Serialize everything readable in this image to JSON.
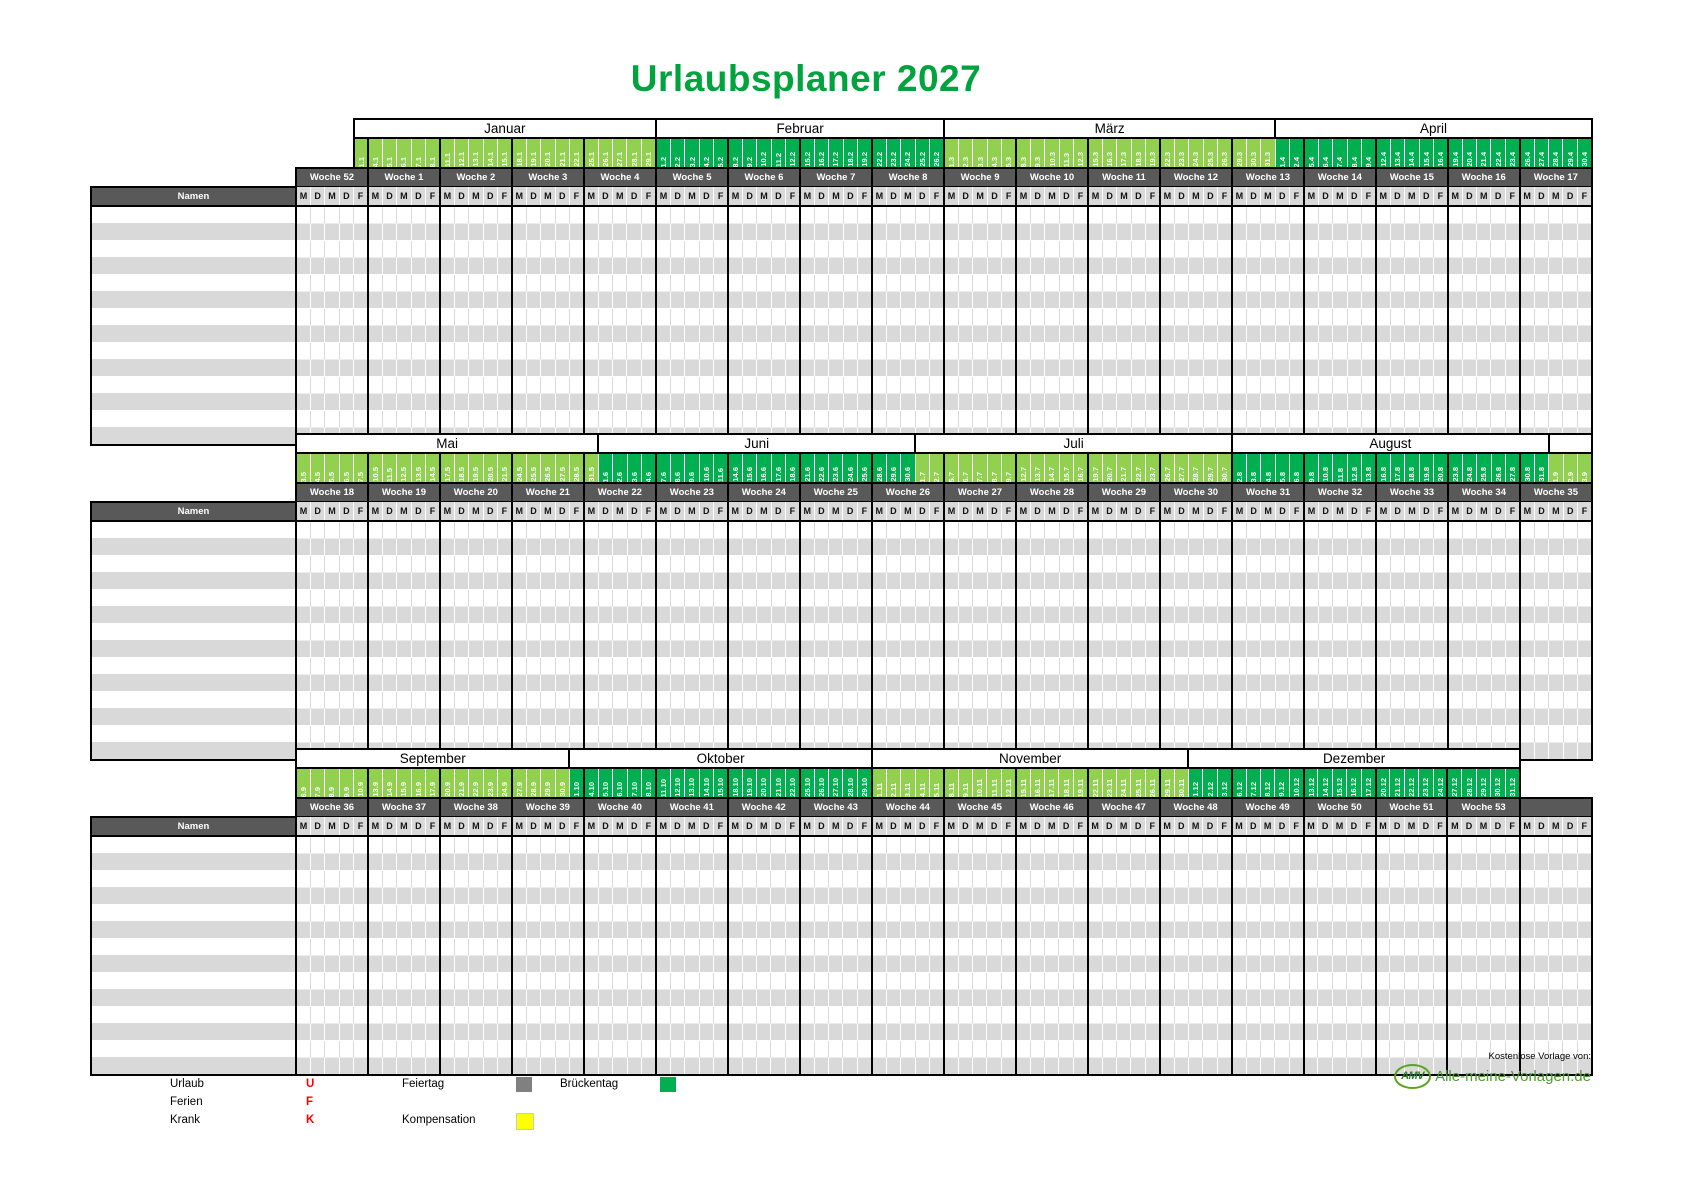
{
  "title": "Urlaubsplaner 2027",
  "names_label": "Namen",
  "day_letters": [
    "M",
    "D",
    "M",
    "D",
    "F"
  ],
  "body_rows": 14,
  "colors": {
    "light_green": "#92d050",
    "dark_green": "#00b050",
    "header_gray": "#595959",
    "row_gray": "#d9d9d9",
    "title_green": "#00a33e",
    "legend_red": "#ff0000",
    "feiertag_gray": "#808080",
    "kompensation_yellow": "#ffff00",
    "brueckentag_green": "#00b050",
    "logo_green": "#58a618"
  },
  "layout": {
    "name_col_width": 205,
    "day_col_width": 14.4,
    "band_tops": [
      118,
      433,
      748
    ]
  },
  "bands": [
    {
      "months": [
        {
          "label": "",
          "span": 4,
          "boxed": false
        },
        {
          "label": "Januar",
          "span": 21,
          "boxed": true
        },
        {
          "label": "Februar",
          "span": 20,
          "boxed": true
        },
        {
          "label": "März",
          "span": 23,
          "boxed": true
        },
        {
          "label": "April",
          "span": 22,
          "boxed": true
        }
      ],
      "weeks": [
        {
          "label": "Woche 52",
          "dates": [
            "",
            "",
            "",
            "",
            "1.1"
          ],
          "shade": "L"
        },
        {
          "label": "Woche 1",
          "dates": [
            "4.1",
            "5.1",
            "6.1",
            "7.1",
            "8.1"
          ],
          "shade": "L"
        },
        {
          "label": "Woche 2",
          "dates": [
            "11.1",
            "12.1",
            "13.1",
            "14.1",
            "15.1"
          ],
          "shade": "L"
        },
        {
          "label": "Woche 3",
          "dates": [
            "18.1",
            "19.1",
            "20.1",
            "21.1",
            "22.1"
          ],
          "shade": "L"
        },
        {
          "label": "Woche 4",
          "dates": [
            "25.1",
            "26.1",
            "27.1",
            "28.1",
            "29.1"
          ],
          "shade": "L"
        },
        {
          "label": "Woche 5",
          "dates": [
            "1.2",
            "2.2",
            "3.2",
            "4.2",
            "5.2"
          ],
          "shade": "D"
        },
        {
          "label": "Woche 6",
          "dates": [
            "8.2",
            "9.2",
            "10.2",
            "11.2",
            "12.2"
          ],
          "shade": "D"
        },
        {
          "label": "Woche 7",
          "dates": [
            "15.2",
            "16.2",
            "17.2",
            "18.2",
            "19.2"
          ],
          "shade": "D"
        },
        {
          "label": "Woche 8",
          "dates": [
            "22.2",
            "23.2",
            "24.2",
            "25.2",
            "26.2"
          ],
          "shade": "D"
        },
        {
          "label": "Woche 9",
          "dates": [
            "1.3",
            "2.3",
            "3.3",
            "4.3",
            "5.3"
          ],
          "shade": "L"
        },
        {
          "label": "Woche 10",
          "dates": [
            "8.3",
            "9.3",
            "10.3",
            "11.3",
            "12.3"
          ],
          "shade": "L"
        },
        {
          "label": "Woche 11",
          "dates": [
            "15.3",
            "16.3",
            "17.3",
            "18.3",
            "19.3"
          ],
          "shade": "L"
        },
        {
          "label": "Woche 12",
          "dates": [
            "22.3",
            "23.3",
            "24.3",
            "25.3",
            "26.3"
          ],
          "shade": "L"
        },
        {
          "label": "Woche 13",
          "dates": [
            "29.3",
            "30.3",
            "31.3",
            "1.4",
            "2.4"
          ],
          "shades": [
            "L",
            "L",
            "L",
            "D",
            "D"
          ]
        },
        {
          "label": "Woche 14",
          "dates": [
            "5.4",
            "6.4",
            "7.4",
            "8.4",
            "9.4"
          ],
          "shade": "D"
        },
        {
          "label": "Woche 15",
          "dates": [
            "12.4",
            "13.4",
            "14.4",
            "15.4",
            "16.4"
          ],
          "shade": "D"
        },
        {
          "label": "Woche 16",
          "dates": [
            "19.4",
            "20.4",
            "21.4",
            "22.4",
            "23.4"
          ],
          "shade": "D"
        },
        {
          "label": "Woche 17",
          "dates": [
            "26.4",
            "27.4",
            "28.4",
            "29.4",
            "30.4"
          ],
          "shade": "D"
        }
      ]
    },
    {
      "months": [
        {
          "label": "Mai",
          "span": 21,
          "boxed": true
        },
        {
          "label": "Juni",
          "span": 22,
          "boxed": true
        },
        {
          "label": "Juli",
          "span": 22,
          "boxed": true
        },
        {
          "label": "August",
          "span": 22,
          "boxed": true
        },
        {
          "label": "",
          "span": 3,
          "boxed": true
        }
      ],
      "weeks": [
        {
          "label": "Woche 18",
          "dates": [
            "3.5",
            "4.5",
            "5.5",
            "6.5",
            "7.5"
          ],
          "shade": "L"
        },
        {
          "label": "Woche 19",
          "dates": [
            "10.5",
            "11.5",
            "12.5",
            "13.5",
            "14.5"
          ],
          "shade": "L"
        },
        {
          "label": "Woche 20",
          "dates": [
            "17.5",
            "18.5",
            "19.5",
            "20.5",
            "21.5"
          ],
          "shade": "L"
        },
        {
          "label": "Woche 21",
          "dates": [
            "24.5",
            "25.5",
            "26.5",
            "27.5",
            "28.5"
          ],
          "shade": "L"
        },
        {
          "label": "Woche 22",
          "dates": [
            "31.5",
            "1.6",
            "2.6",
            "3.6",
            "4.6"
          ],
          "shades": [
            "L",
            "D",
            "D",
            "D",
            "D"
          ]
        },
        {
          "label": "Woche 23",
          "dates": [
            "7.6",
            "8.6",
            "9.6",
            "10.6",
            "11.6"
          ],
          "shade": "D"
        },
        {
          "label": "Woche 24",
          "dates": [
            "14.6",
            "15.6",
            "16.6",
            "17.6",
            "18.6"
          ],
          "shade": "D"
        },
        {
          "label": "Woche 25",
          "dates": [
            "21.6",
            "22.6",
            "23.6",
            "24.6",
            "25.6"
          ],
          "shade": "D"
        },
        {
          "label": "Woche 26",
          "dates": [
            "28.6",
            "29.6",
            "30.6",
            "1.7",
            "2.7"
          ],
          "shades": [
            "D",
            "D",
            "D",
            "L",
            "L"
          ]
        },
        {
          "label": "Woche 27",
          "dates": [
            "5.7",
            "6.7",
            "7.7",
            "8.7",
            "9.7"
          ],
          "shade": "L"
        },
        {
          "label": "Woche 28",
          "dates": [
            "12.7",
            "13.7",
            "14.7",
            "15.7",
            "16.7"
          ],
          "shade": "L"
        },
        {
          "label": "Woche 29",
          "dates": [
            "19.7",
            "20.7",
            "21.7",
            "22.7",
            "23.7"
          ],
          "shade": "L"
        },
        {
          "label": "Woche 30",
          "dates": [
            "26.7",
            "27.7",
            "28.7",
            "29.7",
            "30.7"
          ],
          "shade": "L"
        },
        {
          "label": "Woche 31",
          "dates": [
            "2.8",
            "3.8",
            "4.8",
            "5.8",
            "6.8"
          ],
          "shade": "D"
        },
        {
          "label": "Woche 32",
          "dates": [
            "9.8",
            "10.8",
            "11.8",
            "12.8",
            "13.8"
          ],
          "shade": "D"
        },
        {
          "label": "Woche 33",
          "dates": [
            "16.8",
            "17.8",
            "18.8",
            "19.8",
            "20.8"
          ],
          "shade": "D"
        },
        {
          "label": "Woche 34",
          "dates": [
            "23.8",
            "24.8",
            "25.8",
            "26.8",
            "27.8"
          ],
          "shade": "D"
        },
        {
          "label": "Woche 35",
          "dates": [
            "30.8",
            "31.8",
            "1.9",
            "2.9",
            "3.9"
          ],
          "shades": [
            "D",
            "D",
            "L",
            "L",
            "L"
          ]
        }
      ]
    },
    {
      "months": [
        {
          "label": "September",
          "span": 19,
          "boxed": true
        },
        {
          "label": "Oktober",
          "span": 21,
          "boxed": true
        },
        {
          "label": "November",
          "span": 22,
          "boxed": true
        },
        {
          "label": "Dezember",
          "span": 23,
          "boxed": true
        },
        {
          "label": "",
          "span": 5,
          "boxed": false
        }
      ],
      "weeks": [
        {
          "label": "Woche 36",
          "dates": [
            "6.9",
            "7.9",
            "8.9",
            "9.9",
            "10.9"
          ],
          "shade": "L"
        },
        {
          "label": "Woche 37",
          "dates": [
            "13.9",
            "14.9",
            "15.9",
            "16.9",
            "17.9"
          ],
          "shade": "L"
        },
        {
          "label": "Woche 38",
          "dates": [
            "20.9",
            "21.9",
            "22.9",
            "23.9",
            "24.9"
          ],
          "shade": "L"
        },
        {
          "label": "Woche 39",
          "dates": [
            "27.9",
            "28.9",
            "29.9",
            "30.9",
            "1.10"
          ],
          "shades": [
            "L",
            "L",
            "L",
            "L",
            "D"
          ]
        },
        {
          "label": "Woche 40",
          "dates": [
            "4.10",
            "5.10",
            "6.10",
            "7.10",
            "8.10"
          ],
          "shade": "D"
        },
        {
          "label": "Woche 41",
          "dates": [
            "11.10",
            "12.10",
            "13.10",
            "14.10",
            "15.10"
          ],
          "shade": "D"
        },
        {
          "label": "Woche 42",
          "dates": [
            "18.10",
            "19.10",
            "20.10",
            "21.10",
            "22.10"
          ],
          "shade": "D"
        },
        {
          "label": "Woche 43",
          "dates": [
            "25.10",
            "26.10",
            "27.10",
            "28.10",
            "29.10"
          ],
          "shade": "D"
        },
        {
          "label": "Woche 44",
          "dates": [
            "1.11",
            "2.11",
            "3.11",
            "4.11",
            "5.11"
          ],
          "shade": "L"
        },
        {
          "label": "Woche 45",
          "dates": [
            "8.11",
            "9.11",
            "10.11",
            "11.11",
            "12.11"
          ],
          "shade": "L"
        },
        {
          "label": "Woche 46",
          "dates": [
            "15.11",
            "16.11",
            "17.11",
            "18.11",
            "19.11"
          ],
          "shade": "L"
        },
        {
          "label": "Woche 47",
          "dates": [
            "22.11",
            "23.11",
            "24.11",
            "25.11",
            "26.11"
          ],
          "shade": "L"
        },
        {
          "label": "Woche 48",
          "dates": [
            "29.11",
            "30.11",
            "1.12",
            "2.12",
            "3.12"
          ],
          "shades": [
            "L",
            "L",
            "D",
            "D",
            "D"
          ]
        },
        {
          "label": "Woche 49",
          "dates": [
            "6.12",
            "7.12",
            "8.12",
            "9.12",
            "10.12"
          ],
          "shade": "D"
        },
        {
          "label": "Woche 50",
          "dates": [
            "13.12",
            "14.12",
            "15.12",
            "16.12",
            "17.12"
          ],
          "shade": "D"
        },
        {
          "label": "Woche 51",
          "dates": [
            "20.12",
            "21.12",
            "22.12",
            "23.12",
            "24.12"
          ],
          "shade": "D"
        },
        {
          "label": "Woche 53",
          "dates": [
            "27.12",
            "28.12",
            "29.12",
            "30.12",
            "31.12"
          ],
          "shade": "D"
        },
        {
          "label": "",
          "dates": [
            "",
            "",
            "",
            "",
            ""
          ],
          "shade": ""
        }
      ]
    }
  ],
  "legend": {
    "urlaub_label": "Urlaub",
    "urlaub_code": "U",
    "ferien_label": "Ferien",
    "ferien_code": "F",
    "krank_label": "Krank",
    "krank_code": "K",
    "feiertag_label": "Feiertag",
    "kompensation_label": "Kompensation",
    "brueckentag_label": "Brückentag"
  },
  "footer": {
    "credit": "Kostenlose Vorlage von:",
    "logo_abbr": "AMV",
    "logo_text": "Alle-meine-Vorlagen.de"
  }
}
